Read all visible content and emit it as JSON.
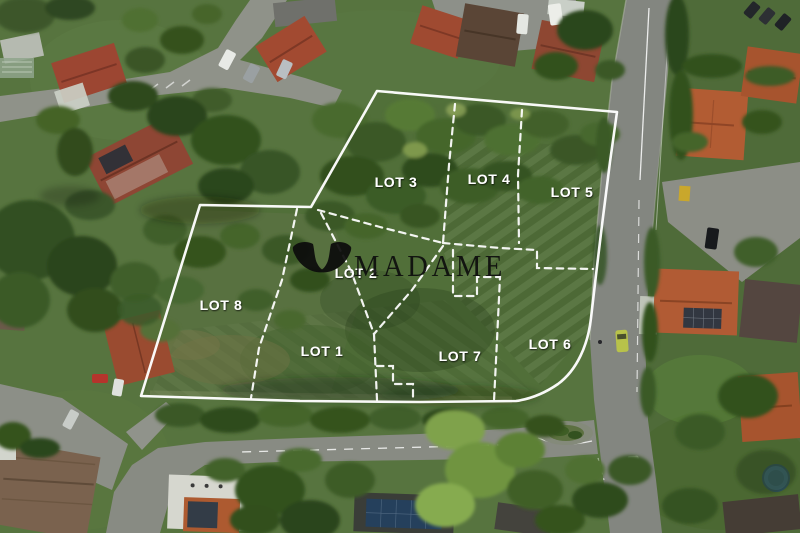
{
  "page": {
    "type": "aerial-land-subdivision-photo"
  },
  "watermark": {
    "brand": "MADAME",
    "logo": "madame-wings-logo"
  },
  "lots": [
    {
      "id": "1",
      "label": "LOT 1"
    },
    {
      "id": "2",
      "label": "LOT 2"
    },
    {
      "id": "3",
      "label": "LOT 3"
    },
    {
      "id": "4",
      "label": "LOT 4"
    },
    {
      "id": "5",
      "label": "LOT 5"
    },
    {
      "id": "6",
      "label": "LOT 6"
    },
    {
      "id": "7",
      "label": "LOT 7"
    },
    {
      "id": "8",
      "label": "LOT 8"
    }
  ],
  "overlay": {
    "boundary_color": "#ffffff",
    "divider_style": "dashed",
    "label_color": "#ffffff",
    "watermark_color": "#0e0e0e"
  }
}
